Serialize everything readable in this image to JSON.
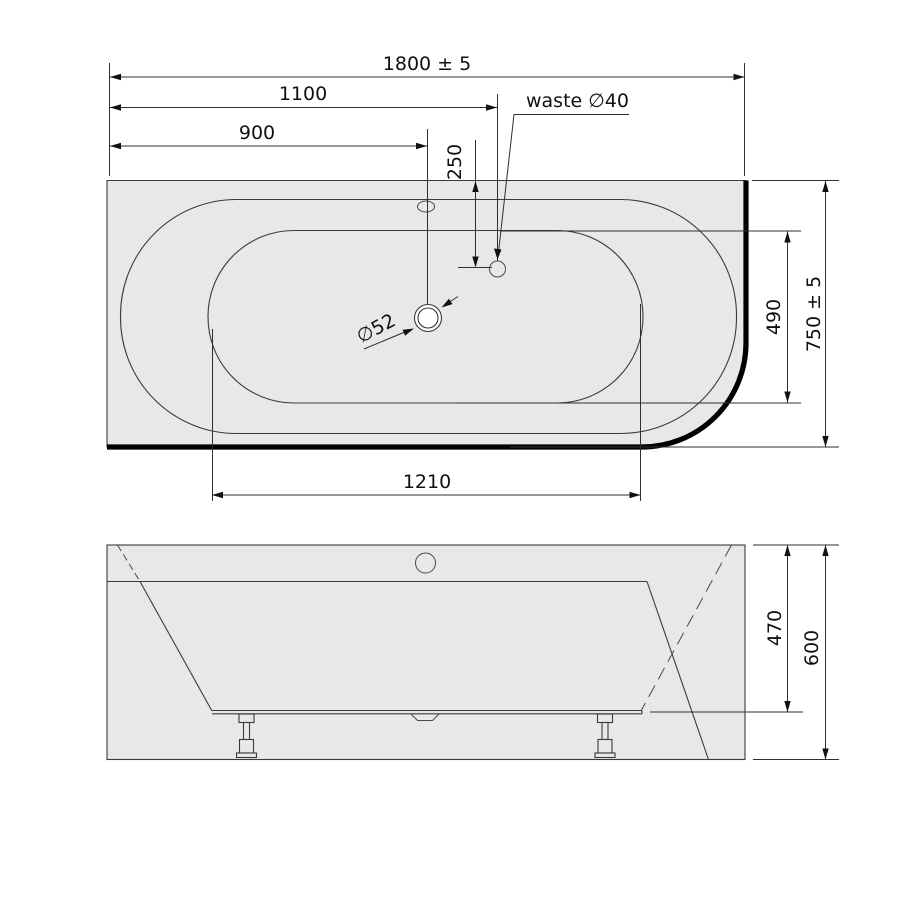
{
  "colors": {
    "background": "#ffffff",
    "tub_fill": "#e7e8e8",
    "line": "#3b3b3b",
    "thick_edge": "#000000",
    "dimension_text": "#111111"
  },
  "plan_view": {
    "dim_length_total": "1800 ± 5",
    "dim_length_to_waste": "1100",
    "dim_length_to_drain": "900",
    "dim_waste_from_edge": "250",
    "waste_label": "waste ∅40",
    "drain_label": "∅52",
    "dim_basin_width": "490",
    "dim_width_total": "750 ± 5",
    "dim_basin_length": "1210"
  },
  "front_view": {
    "dim_height_shell": "470",
    "dim_height_total": "600"
  }
}
